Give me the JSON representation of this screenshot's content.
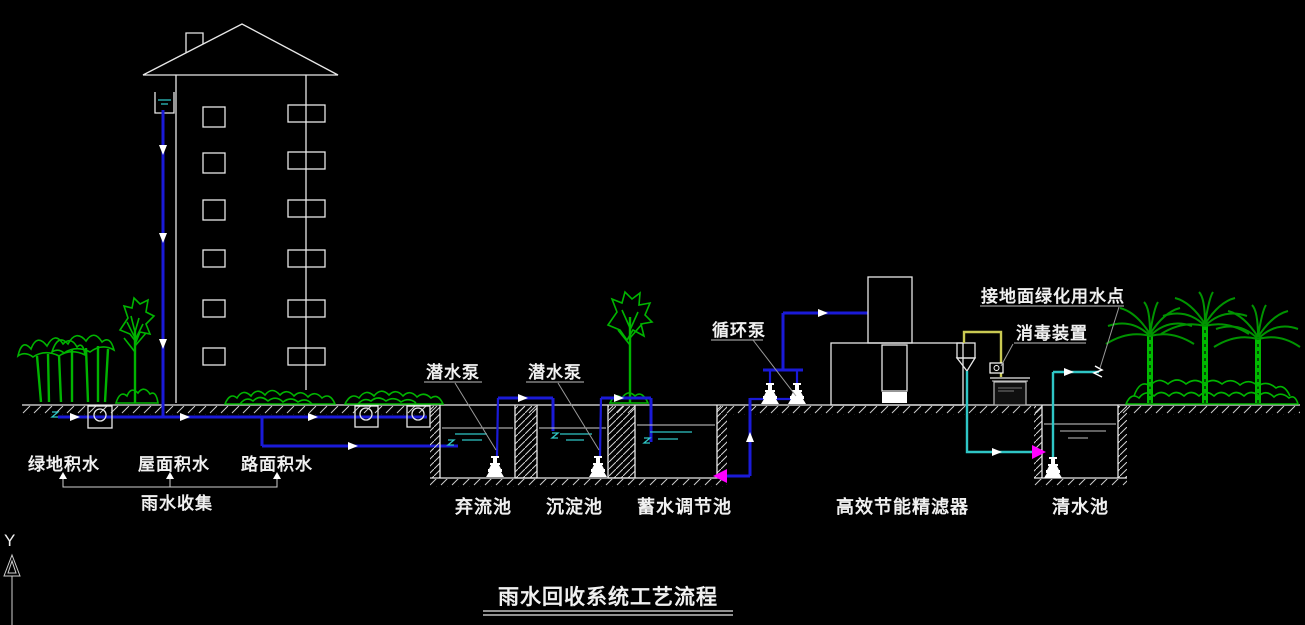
{
  "drawing": {
    "title": "雨水回收系统工艺流程",
    "labels": {
      "green_area_water": "绿地积水",
      "roof_water": "屋面积水",
      "road_water": "路面积水",
      "rain_collection": "雨水收集",
      "submersible_pump_1": "潜水泵",
      "submersible_pump_2": "潜水泵",
      "discard_tank": "弃流池",
      "sediment_tank": "沉淀池",
      "storage_tank": "蓄水调节池",
      "circulation_pump": "循环泵",
      "filter": "高效节能精滤器",
      "clean_tank": "清水池",
      "disinfection": "消毒装置",
      "water_point": "接地面绿化用水点",
      "axis_y": "Y"
    },
    "colors": {
      "background": "#000000",
      "line_white": "#e8e8e8",
      "pipe_blue": "#1a1ad8",
      "pipe_cyan": "#2fc6c6",
      "pipe_yellow": "#c9c952",
      "flow_magenta": "#ff00ff",
      "vegetation_green": "#00b400",
      "vegetation_dark": "#009400"
    }
  }
}
